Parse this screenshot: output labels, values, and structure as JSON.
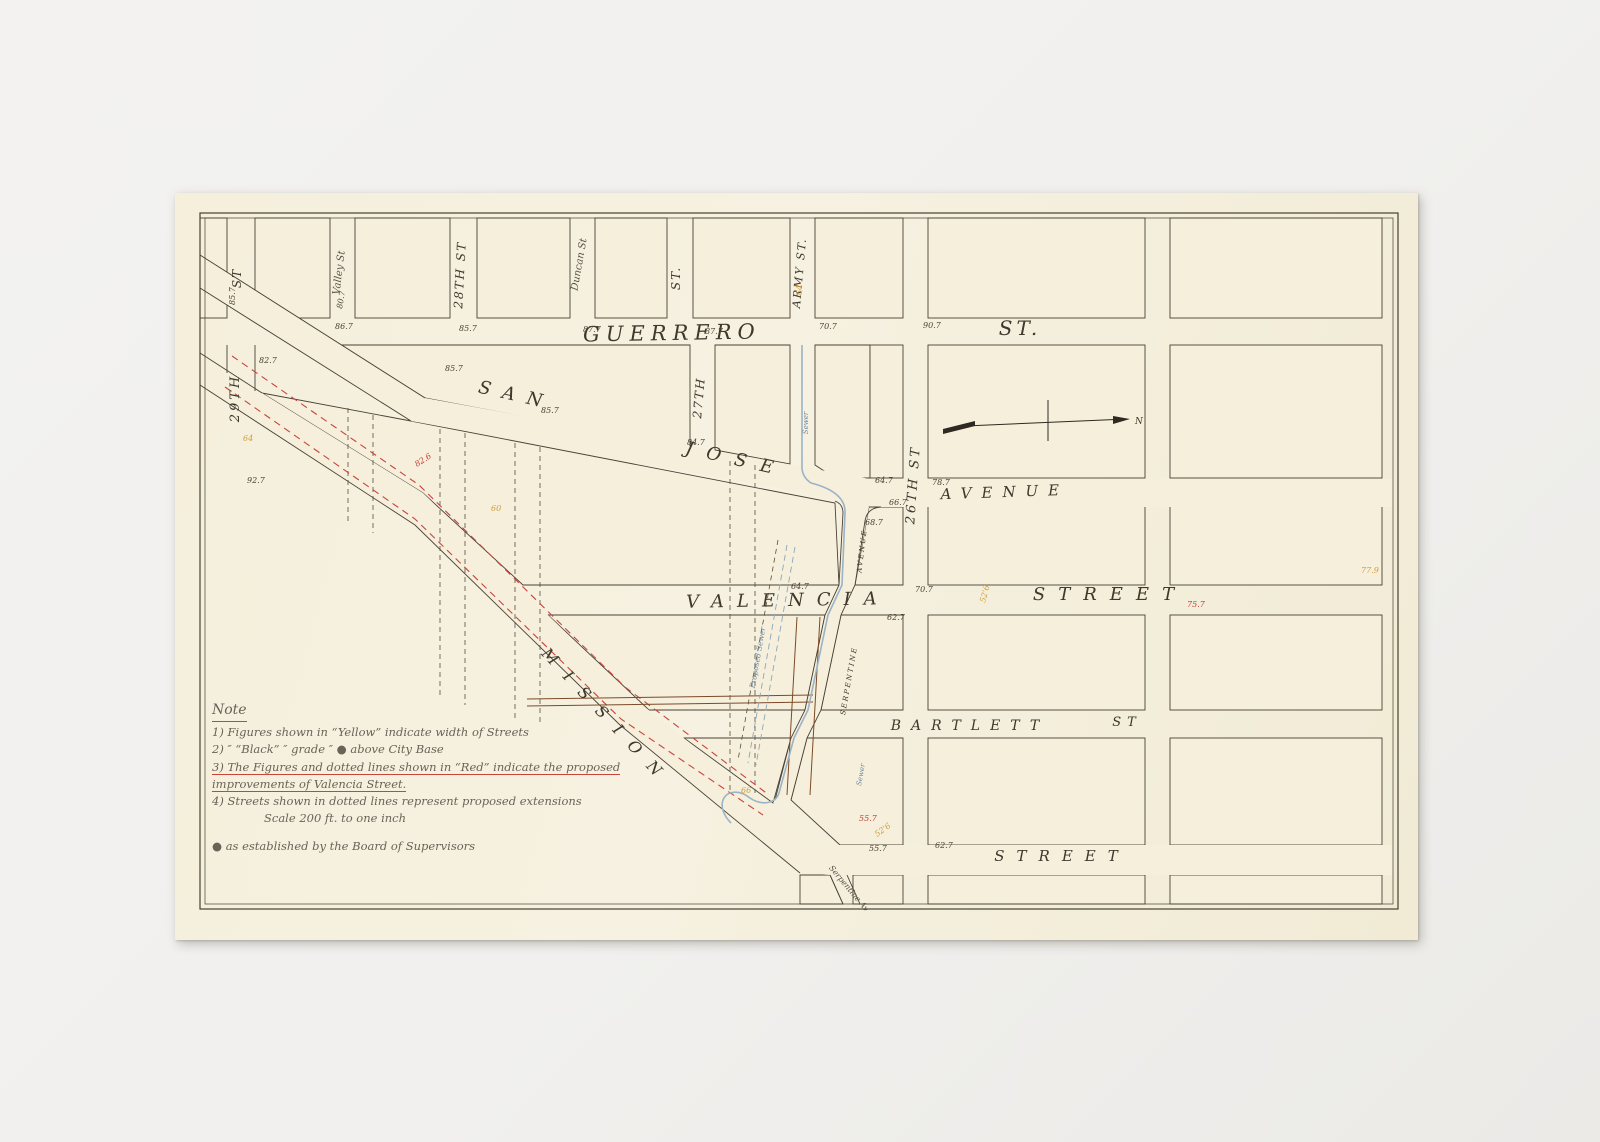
{
  "artwork": {
    "mat_color": "#f1f0ee",
    "paper_color": "#f5efdc",
    "ink_color": "#4a4236",
    "red_color": "#c23b35",
    "yellow_color": "#cf9f3a",
    "blue_color": "#9ab3c6",
    "brown_color": "#7c4b28"
  },
  "map": {
    "streets": {
      "guerrero": "GUERRERO",
      "guerrero_st": "ST.",
      "san": "SAN",
      "jose": "JOSE",
      "avenue": "AVENUE",
      "valencia": "VALENCIA",
      "valencia_street": "STREET",
      "bartlett": "BARTLETT",
      "bartlett_st": "ST",
      "mission": "MISSION",
      "mission_street": "STREET",
      "serpentine": "SERPENTINE",
      "serpentine_avenue": "AVENUE",
      "serpentine_av_lower": "Serpentine Av",
      "st29": "29TH",
      "st29_suffix": "ST",
      "valley": "Valley St",
      "st28": "28TH ST",
      "duncan": "Duncan St",
      "st27": "27TH",
      "st27_suffix": "ST.",
      "army": "ARMY ST.",
      "st26": "26TH ST",
      "sewer_upper": "Sewer",
      "sewer_lower": "Sewer",
      "proposed_sewer": "Proposed Sewer",
      "north": "N"
    },
    "annotations": [
      {
        "t": "85.7",
        "x": 60,
        "y": 112,
        "c": "k",
        "r": -90
      },
      {
        "t": "80.7",
        "x": 167,
        "y": 116,
        "c": "k",
        "r": -80
      },
      {
        "t": "86.7",
        "x": 160,
        "y": 136,
        "c": "k"
      },
      {
        "t": "85.7",
        "x": 284,
        "y": 138,
        "c": "k"
      },
      {
        "t": "87.7",
        "x": 408,
        "y": 139,
        "c": "k"
      },
      {
        "t": "87.7",
        "x": 530,
        "y": 141,
        "c": "k"
      },
      {
        "t": "70.7",
        "x": 644,
        "y": 136,
        "c": "k"
      },
      {
        "t": "90.7",
        "x": 748,
        "y": 135,
        "c": "k"
      },
      {
        "t": "82.7",
        "x": 84,
        "y": 170,
        "c": "k"
      },
      {
        "t": "85.7",
        "x": 270,
        "y": 178,
        "c": "k"
      },
      {
        "t": "85.7",
        "x": 366,
        "y": 220,
        "c": "k"
      },
      {
        "t": "84.7",
        "x": 512,
        "y": 252,
        "c": "k"
      },
      {
        "t": "64",
        "x": 68,
        "y": 248,
        "c": "y"
      },
      {
        "t": "92.7",
        "x": 72,
        "y": 290,
        "c": "k"
      },
      {
        "t": "82.6",
        "x": 242,
        "y": 274,
        "c": "r",
        "r": -33
      },
      {
        "t": "60",
        "x": 316,
        "y": 318,
        "c": "y"
      },
      {
        "t": "64",
        "x": 627,
        "y": 102,
        "c": "y",
        "r": -90
      },
      {
        "t": "64.7",
        "x": 700,
        "y": 290,
        "c": "k"
      },
      {
        "t": "78.7",
        "x": 757,
        "y": 292,
        "c": "k"
      },
      {
        "t": "66.7",
        "x": 714,
        "y": 312,
        "c": "k"
      },
      {
        "t": "68.7",
        "x": 690,
        "y": 332,
        "c": "k"
      },
      {
        "t": "64.7",
        "x": 616,
        "y": 396,
        "c": "k"
      },
      {
        "t": "70.7",
        "x": 740,
        "y": 399,
        "c": "k"
      },
      {
        "t": "62.7",
        "x": 712,
        "y": 427,
        "c": "k"
      },
      {
        "t": "52'6",
        "x": 810,
        "y": 410,
        "c": "y",
        "r": -75
      },
      {
        "t": "75.7",
        "x": 1012,
        "y": 414,
        "c": "r"
      },
      {
        "t": "77.9",
        "x": 1186,
        "y": 380,
        "c": "y"
      },
      {
        "t": "66",
        "x": 566,
        "y": 600,
        "c": "y"
      },
      {
        "t": "55.7",
        "x": 684,
        "y": 628,
        "c": "r"
      },
      {
        "t": "52'6",
        "x": 702,
        "y": 644,
        "c": "y",
        "r": -35
      },
      {
        "t": "55.7",
        "x": 694,
        "y": 658,
        "c": "k"
      },
      {
        "t": "62.7",
        "x": 760,
        "y": 655,
        "c": "k"
      }
    ]
  },
  "note": {
    "title": "Note",
    "lines": [
      [
        {
          "t": "1) Figures shown in “Yellow” indicate width of Streets"
        }
      ],
      [
        {
          "t": "2)        ″        “Black”      ″      grade      ″        ● above City Base"
        }
      ],
      [
        {
          "t": "3) The Figures and dotted lines shown in “Red” indicate the proposed",
          "ru": true
        }
      ],
      [
        {
          "t": "improvements of ",
          "ru": true
        },
        {
          "t": "Valencia Street.",
          "ru": true
        }
      ],
      [
        {
          "t": "4) Streets shown in dotted lines represent proposed extensions"
        }
      ],
      [
        {
          "t": "Scale 200 ft. to one inch",
          "indent": true
        }
      ],
      [
        {
          "t": "● as established by the Board of Supervisors",
          "gap": true
        }
      ]
    ]
  }
}
